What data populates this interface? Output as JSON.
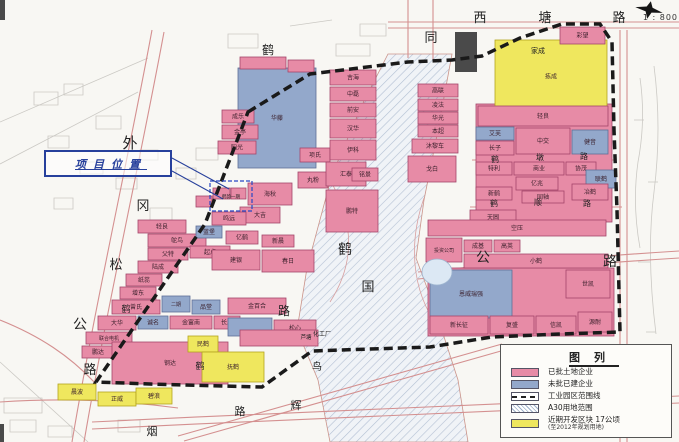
{
  "scale_label": "1 : 800",
  "callout": {
    "text": "项目位置"
  },
  "legend": {
    "title": "图列",
    "items": [
      {
        "swatch": "pink",
        "label": "已批土地企业"
      },
      {
        "swatch": "blue",
        "label": "未批已建企业"
      },
      {
        "swatch": "dashed",
        "label": "工业园区范围线"
      },
      {
        "swatch": "hatch",
        "label": "A30用地范围"
      },
      {
        "swatch": "yellow",
        "label": "近期开发区块  17公顷",
        "sublabel": "(至2012年规划用地)"
      }
    ]
  },
  "colors": {
    "p": {
      "f": "#e78ba6",
      "s": "#a34569"
    },
    "b": {
      "f": "#93a8cb",
      "s": "#5e6f96"
    },
    "y": {
      "f": "#efe75e",
      "s": "#b3a31f"
    }
  },
  "map": {
    "boundary": "248,112 310,74 408,62 452,60 482,56 520,38 562,24 600,24 612,42 614,130 617,210 620,332 560,334 492,337 430,347 312,351 262,387 150,384 96,382 205,224",
    "corridor": "388,54 452,54 438,130 424,200 416,258 436,312 458,380 468,442 330,442 318,380 297,330 307,268 332,175 362,105",
    "site_rect": {
      "x": 210,
      "y": 181,
      "w": 42,
      "h": 30
    },
    "pond": {
      "cx": 437,
      "cy": 272,
      "rx": 15,
      "ry": 13
    },
    "leader_lines": [
      "M172 158 L229 189",
      "M172 171 L223 199"
    ],
    "dark_blocks": [
      {
        "x": 455,
        "y": 32,
        "w": 22,
        "h": 40
      },
      {
        "x": 0,
        "y": 0,
        "w": 5,
        "h": 20
      },
      {
        "x": 0,
        "y": 424,
        "w": 4,
        "h": 18
      }
    ],
    "roads": [
      {
        "d": "M388 22 H679"
      },
      {
        "d": "M388 28 H679"
      },
      {
        "d": "M408 0 V58"
      },
      {
        "d": "M433 0 V60"
      },
      {
        "d": "M152 30 C128 160 96 300 72 442"
      },
      {
        "d": "M164 32 C140 162 108 302 84 442"
      },
      {
        "d": "M472 160 H616",
        "w": 0.9
      },
      {
        "d": "M470 207 H622",
        "w": 0.9
      },
      {
        "d": "M418 272 C500 264 600 256 679 251"
      },
      {
        "d": "M418 279 C500 271 600 263 679 258"
      },
      {
        "d": "M92 422 C300 412 520 402 679 396"
      },
      {
        "d": "M92 429 C300 419 520 409 679 403"
      },
      {
        "d": "M178 436 L502 344"
      },
      {
        "d": "M184 441 L508 349"
      },
      {
        "d": "M620 30 V442"
      },
      {
        "d": "M627 30 V442"
      },
      {
        "d": "M330 180 C356 225 354 265 330 302",
        "c": "#d8a0a0",
        "w": 0.8
      },
      {
        "d": "M424 198 C406 250 414 300 444 334",
        "c": "#d8a0a0",
        "w": 0.8
      },
      {
        "d": "M0 320 C40 336 70 356 96 384"
      },
      {
        "d": "M0 402 C60 398 120 400 178 408"
      }
    ],
    "sketch": [
      "M34 92 h24 v13 h-24 z",
      "M64 84 h19 v11 h-19 z",
      "M96 116 h25 v13 h-25 z",
      "M48 136 h21 v12 h-21 z",
      "M80 162 h23 v12 h-23 z",
      "M116 178 h21 v11 h-21 z",
      "M54 198 h19 v11 h-19 z",
      "M140 150 h18 v10 h-18 z",
      "M0 122 L148 58",
      "M0 164 L138 92",
      "M228 34 h30 v14 h-30 z",
      "M290 26 l42 -6",
      "M336 44 h34 v12 h-34 z",
      "M360 24 h26 v12 h-26 z",
      "M640 78 q6 42 -2 84 q-6 42 2 86",
      "M654 66 q8 62 0 126 q-8 62 2 142",
      "M634 120 h10",
      "M648 182 h10",
      "M638 262 h12",
      "M646 332 h10",
      "M4 398 h38 v15 h-38 z",
      "M10 420 h26 v12 h-26 z",
      "M48 426 h24 v11 h-24 z",
      "M118 420 h22 v12 h-22 z",
      "M0 362 L88 442",
      "M150 208 h22 v12 h-22 z",
      "M176 168 h20 v11 h-20 z",
      "M196 148 h22 v12 h-22 z"
    ],
    "parcels": [
      {
        "x": 476,
        "y": 104,
        "w": 136,
        "h": 118,
        "c": "p",
        "l": ""
      },
      {
        "x": 428,
        "y": 268,
        "w": 186,
        "h": 68,
        "c": "p",
        "l": ""
      },
      {
        "x": 495,
        "y": 40,
        "w": 112,
        "h": 73,
        "c": "y",
        "l": "拣成"
      },
      {
        "x": 560,
        "y": 27,
        "w": 45,
        "h": 17,
        "c": "p",
        "l": "彩望"
      },
      {
        "x": 238,
        "y": 68,
        "w": 78,
        "h": 100,
        "c": "b",
        "l": "华藤"
      },
      {
        "x": 240,
        "y": 57,
        "w": 46,
        "h": 12,
        "c": "p",
        "l": ""
      },
      {
        "x": 288,
        "y": 60,
        "w": 26,
        "h": 12,
        "c": "p",
        "l": ""
      },
      {
        "x": 222,
        "y": 110,
        "w": 32,
        "h": 13,
        "c": "p",
        "l": "成乐"
      },
      {
        "x": 222,
        "y": 125,
        "w": 36,
        "h": 14,
        "c": "p",
        "l": "金亭"
      },
      {
        "x": 218,
        "y": 141,
        "w": 38,
        "h": 13,
        "c": "p",
        "l": "阳光"
      },
      {
        "x": 248,
        "y": 183,
        "w": 44,
        "h": 22,
        "c": "p",
        "l": "海秋"
      },
      {
        "x": 298,
        "y": 172,
        "w": 30,
        "h": 16,
        "c": "p",
        "l": "丸粉"
      },
      {
        "x": 240,
        "y": 207,
        "w": 40,
        "h": 16,
        "c": "p",
        "l": "大吉"
      },
      {
        "x": 300,
        "y": 148,
        "w": 30,
        "h": 14,
        "c": "p",
        "l": "项氏"
      },
      {
        "x": 330,
        "y": 70,
        "w": 46,
        "h": 15,
        "c": "p",
        "l": "吉海"
      },
      {
        "x": 330,
        "y": 87,
        "w": 46,
        "h": 14,
        "c": "p",
        "l": "中磊"
      },
      {
        "x": 330,
        "y": 103,
        "w": 46,
        "h": 14,
        "c": "p",
        "l": "前安"
      },
      {
        "x": 330,
        "y": 119,
        "w": 46,
        "h": 19,
        "c": "p",
        "l": "汉华"
      },
      {
        "x": 330,
        "y": 140,
        "w": 46,
        "h": 20,
        "c": "p",
        "l": "伊科"
      },
      {
        "x": 326,
        "y": 162,
        "w": 40,
        "h": 24,
        "c": "p",
        "l": "汇泰"
      },
      {
        "x": 352,
        "y": 168,
        "w": 26,
        "h": 13,
        "c": "p",
        "l": "铭景"
      },
      {
        "x": 326,
        "y": 190,
        "w": 52,
        "h": 42,
        "c": "p",
        "l": "鹏特"
      },
      {
        "x": 418,
        "y": 84,
        "w": 40,
        "h": 13,
        "c": "p",
        "l": "高联"
      },
      {
        "x": 418,
        "y": 99,
        "w": 40,
        "h": 12,
        "c": "p",
        "l": "凌法"
      },
      {
        "x": 418,
        "y": 112,
        "w": 40,
        "h": 12,
        "c": "p",
        "l": "华光"
      },
      {
        "x": 418,
        "y": 125,
        "w": 40,
        "h": 12,
        "c": "p",
        "l": "本超"
      },
      {
        "x": 412,
        "y": 139,
        "w": 46,
        "h": 14,
        "c": "p",
        "l": "沐黎车"
      },
      {
        "x": 408,
        "y": 156,
        "w": 48,
        "h": 26,
        "c": "p",
        "l": "戈白"
      },
      {
        "x": 478,
        "y": 106,
        "w": 130,
        "h": 20,
        "c": "p",
        "l": "轻良"
      },
      {
        "x": 476,
        "y": 127,
        "w": 38,
        "h": 13,
        "c": "b",
        "l": "艾芙"
      },
      {
        "x": 516,
        "y": 128,
        "w": 54,
        "h": 26,
        "c": "p",
        "l": "中交"
      },
      {
        "x": 572,
        "y": 130,
        "w": 36,
        "h": 24,
        "c": "b",
        "l": "健音"
      },
      {
        "x": 476,
        "y": 141,
        "w": 38,
        "h": 14,
        "c": "p",
        "l": "长子"
      },
      {
        "x": 476,
        "y": 162,
        "w": 36,
        "h": 13,
        "c": "p",
        "l": "特利"
      },
      {
        "x": 514,
        "y": 162,
        "w": 50,
        "h": 13,
        "c": "p",
        "l": "商业"
      },
      {
        "x": 566,
        "y": 162,
        "w": 30,
        "h": 13,
        "c": "p",
        "l": "协茂"
      },
      {
        "x": 586,
        "y": 170,
        "w": 30,
        "h": 18,
        "c": "b",
        "l": "联鹤"
      },
      {
        "x": 516,
        "y": 177,
        "w": 42,
        "h": 13,
        "c": "p",
        "l": "亿兆"
      },
      {
        "x": 476,
        "y": 187,
        "w": 36,
        "h": 13,
        "c": "p",
        "l": "新鹤"
      },
      {
        "x": 522,
        "y": 191,
        "w": 42,
        "h": 12,
        "c": "p",
        "l": "同轴"
      },
      {
        "x": 572,
        "y": 184,
        "w": 36,
        "h": 16,
        "c": "p",
        "l": "冶鹤"
      },
      {
        "x": 470,
        "y": 210,
        "w": 46,
        "h": 15,
        "c": "p",
        "l": "天圆"
      },
      {
        "x": 428,
        "y": 220,
        "w": 178,
        "h": 16,
        "c": "p",
        "l": "空压"
      },
      {
        "x": 426,
        "y": 238,
        "w": 36,
        "h": 24,
        "c": "p",
        "l": "投资公司",
        "fs": 5
      },
      {
        "x": 464,
        "y": 240,
        "w": 28,
        "h": 12,
        "c": "p",
        "l": "成基"
      },
      {
        "x": 494,
        "y": 240,
        "w": 26,
        "h": 12,
        "c": "p",
        "l": "高英"
      },
      {
        "x": 464,
        "y": 254,
        "w": 144,
        "h": 14,
        "c": "p",
        "l": "小鹤"
      },
      {
        "x": 430,
        "y": 270,
        "w": 82,
        "h": 48,
        "c": "b",
        "l": "恩威瑞强",
        "fs": 6
      },
      {
        "x": 566,
        "y": 270,
        "w": 44,
        "h": 28,
        "c": "p",
        "l": "世凯"
      },
      {
        "x": 430,
        "y": 316,
        "w": 58,
        "h": 18,
        "c": "p",
        "l": "新长征"
      },
      {
        "x": 490,
        "y": 316,
        "w": 44,
        "h": 18,
        "c": "p",
        "l": "复盛"
      },
      {
        "x": 536,
        "y": 316,
        "w": 40,
        "h": 18,
        "c": "p",
        "l": "信凯"
      },
      {
        "x": 578,
        "y": 312,
        "w": 34,
        "h": 20,
        "c": "p",
        "l": "源耐"
      },
      {
        "x": 138,
        "y": 220,
        "w": 48,
        "h": 13,
        "c": "p",
        "l": "轻良"
      },
      {
        "x": 148,
        "y": 234,
        "w": 58,
        "h": 13,
        "c": "p",
        "l": "鸵鸟"
      },
      {
        "x": 148,
        "y": 248,
        "w": 40,
        "h": 12,
        "c": "p",
        "l": "父特"
      },
      {
        "x": 190,
        "y": 246,
        "w": 40,
        "h": 12,
        "c": "p",
        "l": "起点"
      },
      {
        "x": 138,
        "y": 261,
        "w": 40,
        "h": 12,
        "c": "p",
        "l": "陆成"
      },
      {
        "x": 126,
        "y": 274,
        "w": 36,
        "h": 12,
        "c": "p",
        "l": "纸蕊"
      },
      {
        "x": 120,
        "y": 287,
        "w": 36,
        "h": 12,
        "c": "p",
        "l": "增东"
      },
      {
        "x": 112,
        "y": 300,
        "w": 48,
        "h": 14,
        "c": "p",
        "l": "曾氏"
      },
      {
        "x": 162,
        "y": 296,
        "w": 28,
        "h": 16,
        "c": "b",
        "l": "二期",
        "fs": 5
      },
      {
        "x": 192,
        "y": 300,
        "w": 28,
        "h": 14,
        "c": "b",
        "l": "品堂"
      },
      {
        "x": 98,
        "y": 316,
        "w": 38,
        "h": 14,
        "c": "p",
        "l": "大华"
      },
      {
        "x": 138,
        "y": 316,
        "w": 30,
        "h": 13,
        "c": "b",
        "l": "诚名"
      },
      {
        "x": 170,
        "y": 316,
        "w": 42,
        "h": 13,
        "c": "p",
        "l": "金富南"
      },
      {
        "x": 214,
        "y": 316,
        "w": 26,
        "h": 13,
        "c": "p",
        "l": "长发"
      },
      {
        "x": 86,
        "y": 332,
        "w": 46,
        "h": 12,
        "c": "p",
        "l": "联合电机",
        "fs": 5
      },
      {
        "x": 82,
        "y": 346,
        "w": 32,
        "h": 12,
        "c": "p",
        "l": "鹏达"
      },
      {
        "x": 112,
        "y": 342,
        "w": 116,
        "h": 42,
        "c": "p",
        "l": "钢达"
      },
      {
        "x": 188,
        "y": 336,
        "w": 30,
        "h": 16,
        "c": "y",
        "l": "民鹤"
      },
      {
        "x": 202,
        "y": 352,
        "w": 62,
        "h": 30,
        "c": "y",
        "l": "抚鹤"
      },
      {
        "x": 58,
        "y": 384,
        "w": 38,
        "h": 16,
        "c": "y",
        "l": "晨波"
      },
      {
        "x": 98,
        "y": 392,
        "w": 38,
        "h": 14,
        "c": "y",
        "l": "正威"
      },
      {
        "x": 136,
        "y": 388,
        "w": 36,
        "h": 16,
        "c": "y",
        "l": "碧浪"
      },
      {
        "x": 196,
        "y": 226,
        "w": 26,
        "h": 12,
        "c": "b",
        "l": "蓝堡"
      },
      {
        "x": 226,
        "y": 231,
        "w": 32,
        "h": 13,
        "c": "p",
        "l": "亿鹤"
      },
      {
        "x": 262,
        "y": 235,
        "w": 32,
        "h": 12,
        "c": "p",
        "l": "新晨"
      },
      {
        "x": 212,
        "y": 250,
        "w": 48,
        "h": 20,
        "c": "p",
        "l": "建银"
      },
      {
        "x": 262,
        "y": 250,
        "w": 52,
        "h": 22,
        "c": "p",
        "l": "春日"
      },
      {
        "x": 228,
        "y": 298,
        "w": 58,
        "h": 16,
        "c": "p",
        "l": "金百合"
      },
      {
        "x": 228,
        "y": 318,
        "w": 44,
        "h": 18,
        "c": "b",
        "l": ""
      },
      {
        "x": 274,
        "y": 320,
        "w": 42,
        "h": 16,
        "c": "p",
        "l": "松心"
      },
      {
        "x": 240,
        "y": 330,
        "w": 78,
        "h": 16,
        "c": "p",
        "l": ""
      },
      {
        "x": 212,
        "y": 212,
        "w": 34,
        "h": 13,
        "c": "p",
        "l": "鸣远"
      },
      {
        "x": 196,
        "y": 196,
        "w": 16,
        "h": 11,
        "c": "p",
        "l": ""
      },
      {
        "x": 213,
        "y": 188,
        "w": 17,
        "h": 11,
        "c": "p",
        "l": ""
      },
      {
        "x": 231,
        "y": 188,
        "w": 15,
        "h": 11,
        "c": "p",
        "l": ""
      }
    ],
    "chars": [
      {
        "t": "西",
        "x": 480,
        "y": 22,
        "s": 13
      },
      {
        "t": "塘",
        "x": 545,
        "y": 22,
        "s": 13
      },
      {
        "t": "路",
        "x": 619,
        "y": 22,
        "s": 13
      },
      {
        "t": "同",
        "x": 431,
        "y": 42,
        "s": 13
      },
      {
        "t": "鹤",
        "x": 268,
        "y": 54,
        "s": 12
      },
      {
        "t": "家成",
        "x": 538,
        "y": 53,
        "s": 7
      },
      {
        "t": "外",
        "x": 130,
        "y": 148,
        "s": 15
      },
      {
        "t": "冈",
        "x": 143,
        "y": 210,
        "s": 13
      },
      {
        "t": "松",
        "x": 116,
        "y": 269,
        "s": 13
      },
      {
        "t": "公",
        "x": 80,
        "y": 329,
        "s": 14
      },
      {
        "t": "路",
        "x": 90,
        "y": 374,
        "s": 13
      },
      {
        "t": "鹤",
        "x": 345,
        "y": 254,
        "s": 14
      },
      {
        "t": "国",
        "x": 368,
        "y": 291,
        "s": 13
      },
      {
        "t": "路",
        "x": 284,
        "y": 315,
        "s": 12
      },
      {
        "t": "公",
        "x": 483,
        "y": 262,
        "s": 14
      },
      {
        "t": "路",
        "x": 610,
        "y": 266,
        "s": 14
      },
      {
        "t": "鹤",
        "x": 495,
        "y": 162,
        "s": 8
      },
      {
        "t": "墩",
        "x": 540,
        "y": 160,
        "s": 8
      },
      {
        "t": "路",
        "x": 584,
        "y": 159,
        "s": 8
      },
      {
        "t": "鹤",
        "x": 494,
        "y": 206,
        "s": 8
      },
      {
        "t": "顺",
        "x": 538,
        "y": 205,
        "s": 8
      },
      {
        "t": "路",
        "x": 587,
        "y": 206,
        "s": 8
      },
      {
        "t": "路",
        "x": 240,
        "y": 415,
        "s": 11
      },
      {
        "t": "辉",
        "x": 296,
        "y": 409,
        "s": 11
      },
      {
        "t": "道",
        "x": 600,
        "y": 411,
        "s": 12
      },
      {
        "t": "烟",
        "x": 152,
        "y": 435,
        "s": 11
      },
      {
        "t": "鸟",
        "x": 317,
        "y": 370,
        "s": 10
      },
      {
        "t": "鹤",
        "x": 126,
        "y": 312,
        "s": 9
      },
      {
        "t": "鹤",
        "x": 200,
        "y": 369,
        "s": 9
      },
      {
        "t": "化工厂",
        "x": 322,
        "y": 336,
        "s": 6
      },
      {
        "t": "芦塘",
        "x": 306,
        "y": 339,
        "s": 5.5
      },
      {
        "t": "鹤韵一期",
        "x": 231,
        "y": 198,
        "s": 4.5
      }
    ]
  }
}
